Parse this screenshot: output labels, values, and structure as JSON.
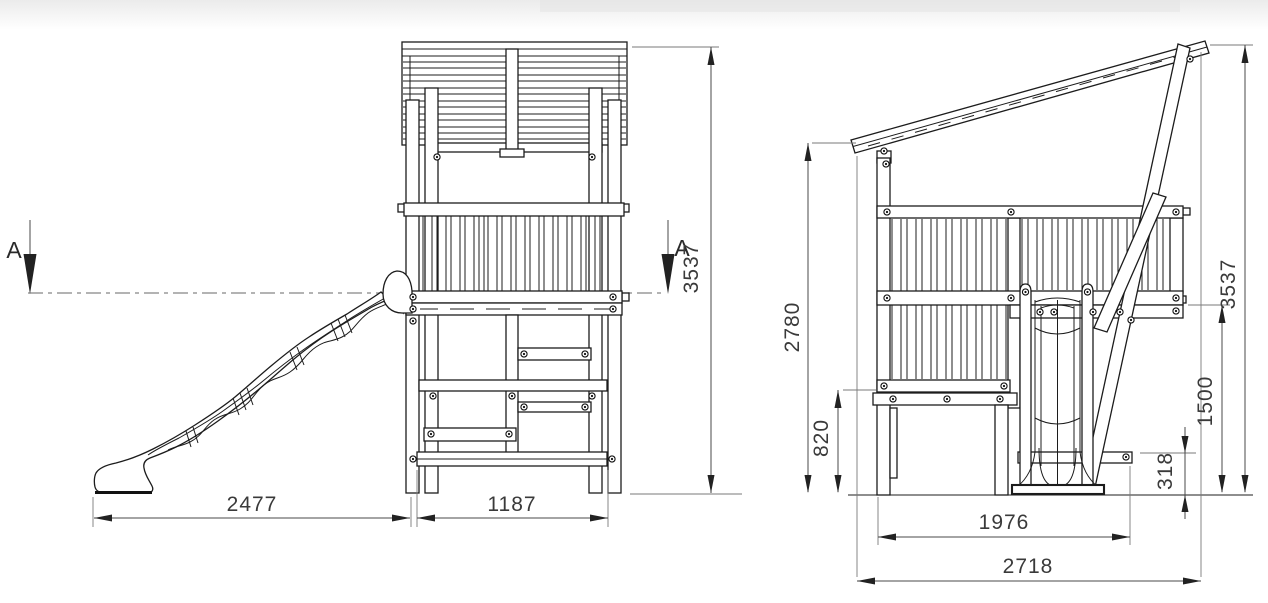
{
  "drawing": {
    "kind": "playground tower with slide - dimensioned technical drawing",
    "section": {
      "left_label": "A",
      "right_label": "A"
    },
    "front_view": {
      "dim_slide_reach": "2477",
      "dim_tower_width": "1187",
      "dim_total_height": "3537"
    },
    "side_view": {
      "dim_front_height": "2780",
      "dim_deck_height": "820",
      "dim_base_length": "1976",
      "dim_overall_length": "2718",
      "dim_step_height": "318",
      "dim_rail_height": "1500",
      "dim_total_height": "3537"
    },
    "colors": {
      "line": "#1c1c1c",
      "dimension": "#4a4a4a",
      "centerline": "#9a9a9a",
      "background": "#ffffff"
    }
  }
}
